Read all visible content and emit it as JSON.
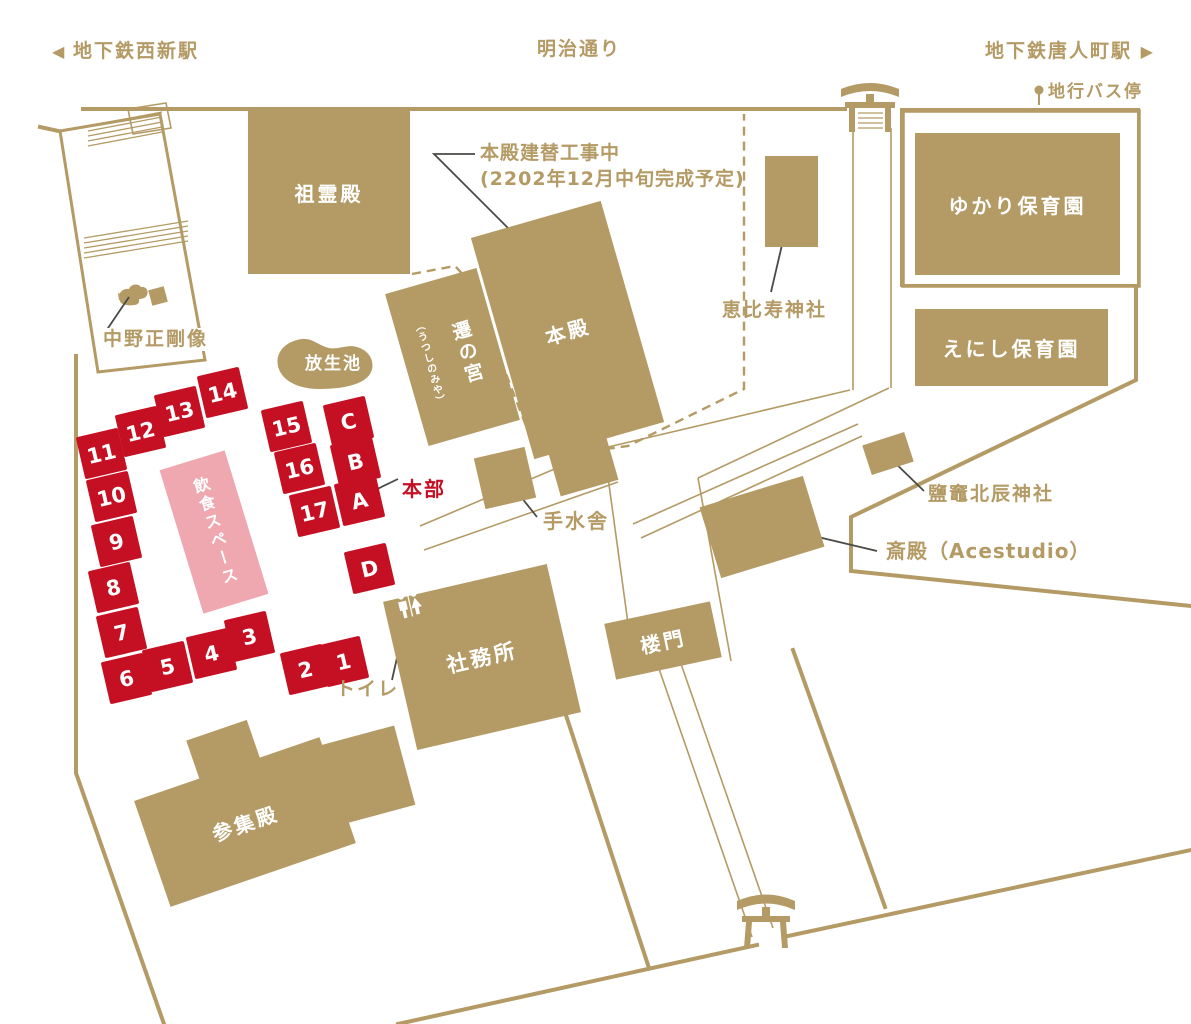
{
  "colors": {
    "tan": "#b49a64",
    "red": "#c50f22",
    "pink": "#efa7b0",
    "leader": "#4a4a46"
  },
  "header": {
    "west_station": "地下鉄西新駅",
    "street": "明治通り",
    "east_station": "地下鉄唐人町駅",
    "bus_stop": "地行バス停",
    "arrow_left": "◀",
    "arrow_right": "▶"
  },
  "notes": {
    "construction_line1": "本殿建替工事中",
    "construction_line2": "(2202年12月中旬完成予定)"
  },
  "buildings": {
    "soreiden": "祖霊殿",
    "honden": "本殿",
    "utsushinomiya": "遷の宮",
    "utsushinomiya_reading": "（うつしのみや）",
    "ebisu": "恵比寿神社",
    "yukari": "ゆかり保育園",
    "enishi": "えにし保育園",
    "pond": "放生池",
    "dining": "飲食スペース",
    "honbu": "本部",
    "temizusha": "手水舎",
    "shiogama": "鹽竈北辰神社",
    "saiden": "斎殿（Acestudio）",
    "shamusho": "社務所",
    "romon": "楼門",
    "sanshuden": "参集殿",
    "nakano_statue": "中野正剛像",
    "toilet": "トイレ"
  },
  "stalls": [
    {
      "label": "1"
    },
    {
      "label": "2"
    },
    {
      "label": "3"
    },
    {
      "label": "4"
    },
    {
      "label": "5"
    },
    {
      "label": "6"
    },
    {
      "label": "7"
    },
    {
      "label": "8"
    },
    {
      "label": "9"
    },
    {
      "label": "10"
    },
    {
      "label": "11"
    },
    {
      "label": "12"
    },
    {
      "label": "13"
    },
    {
      "label": "14"
    },
    {
      "label": "15"
    },
    {
      "label": "16"
    },
    {
      "label": "17"
    },
    {
      "label": "A"
    },
    {
      "label": "B"
    },
    {
      "label": "C"
    },
    {
      "label": "D"
    }
  ]
}
